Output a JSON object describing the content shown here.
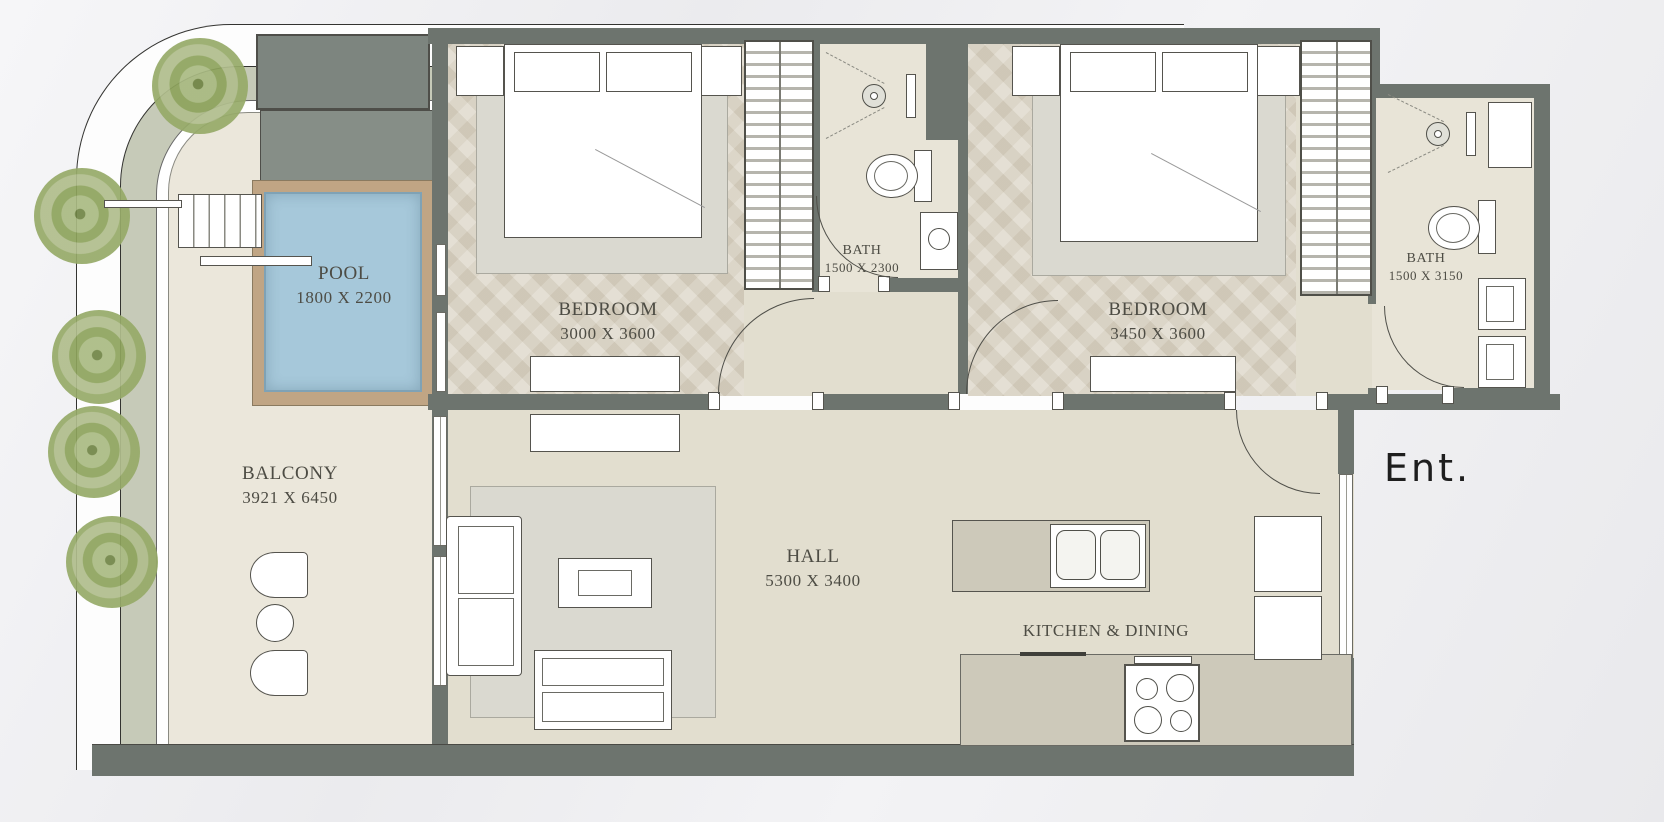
{
  "rooms": {
    "pool": {
      "label": "POOL",
      "dims": "1800 X 2200"
    },
    "balcony": {
      "label": "BALCONY",
      "dims": "3921 X 6450"
    },
    "bedroom1": {
      "label": "BEDROOM",
      "dims": "3000 X 3600"
    },
    "bath1": {
      "label": "BATH",
      "dims": "1500 X 2300"
    },
    "bedroom2": {
      "label": "BEDROOM",
      "dims": "3450 X 3600"
    },
    "bath2": {
      "label": "BATH",
      "dims": "1500 X 3150"
    },
    "hall": {
      "label": "HALL",
      "dims": "5300 X 3400"
    },
    "kitchen": {
      "label": "KITCHEN & DINING"
    },
    "entrance": {
      "label": "Ent."
    }
  },
  "colors": {
    "wall": "#6d746e",
    "wallLight": "#7d857f",
    "wallLighter": "#868e87",
    "floor": "#e2decf",
    "bedroomFloor": "#dbd4c5",
    "bathFloor": "#e8e4d7",
    "balconyFloor": "#ebe7db",
    "counter": "#cdc9ba",
    "rug": "#dad9d0",
    "poolWater": "#a6c8da",
    "poolDeck": "#c0a584",
    "planter": "#c6cab8",
    "labelInk": "#4d4c44",
    "entInk": "#1e1e1e",
    "outline": "#333330"
  }
}
